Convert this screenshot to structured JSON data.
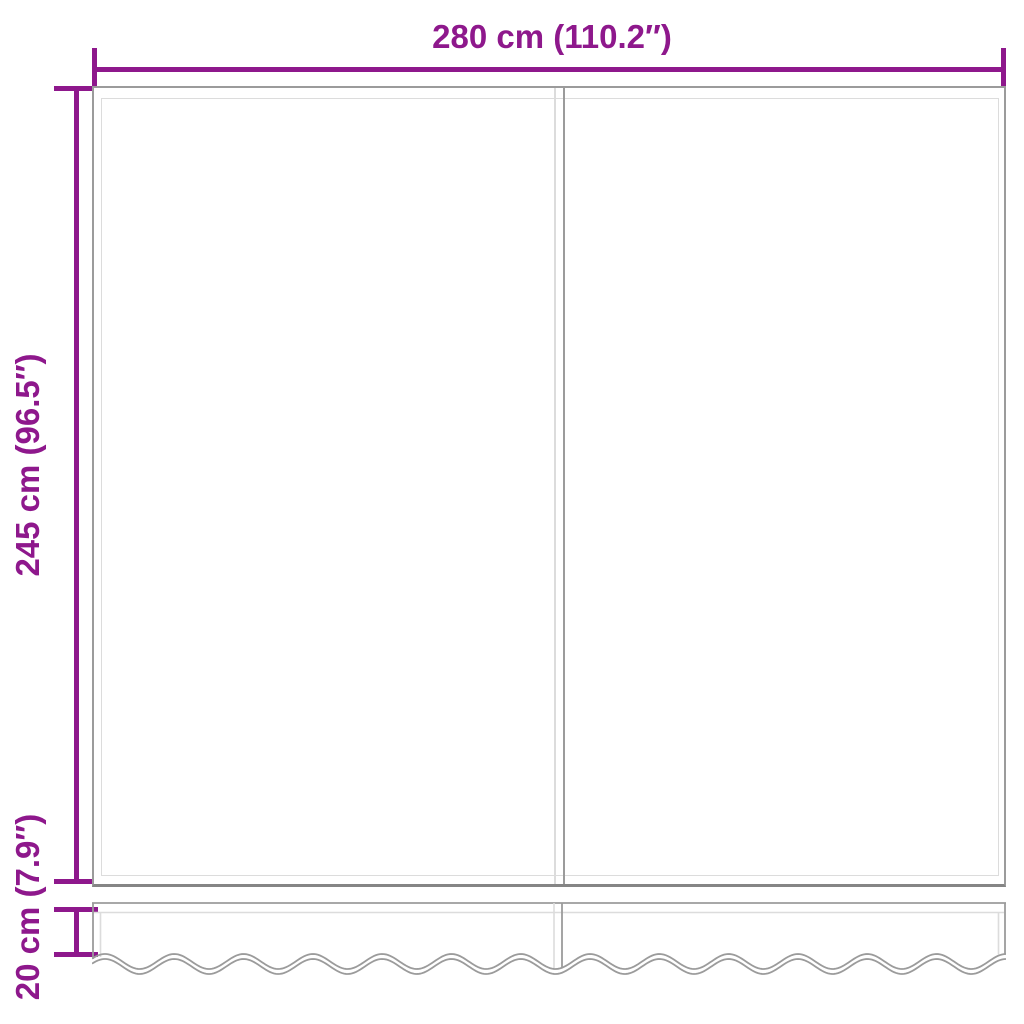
{
  "diagram": {
    "kind": "awning-replacement-fabric-dimension-diagram",
    "colors": {
      "accent": "#8e188c",
      "outline_dark": "#9b9b9b",
      "outline_light": "#dcdcdc",
      "panel_bottom_edge": "#858585",
      "background": "#ffffff"
    },
    "dimensions": {
      "width": {
        "label": "280 cm (110.2″)",
        "value_cm": 280,
        "value_in": 110.2
      },
      "height": {
        "label": "245 cm (96.5″)",
        "value_cm": 245,
        "value_in": 96.5
      },
      "valance": {
        "label": "20 cm (7.9″)",
        "value_cm": 20,
        "value_in": 7.9
      }
    }
  }
}
